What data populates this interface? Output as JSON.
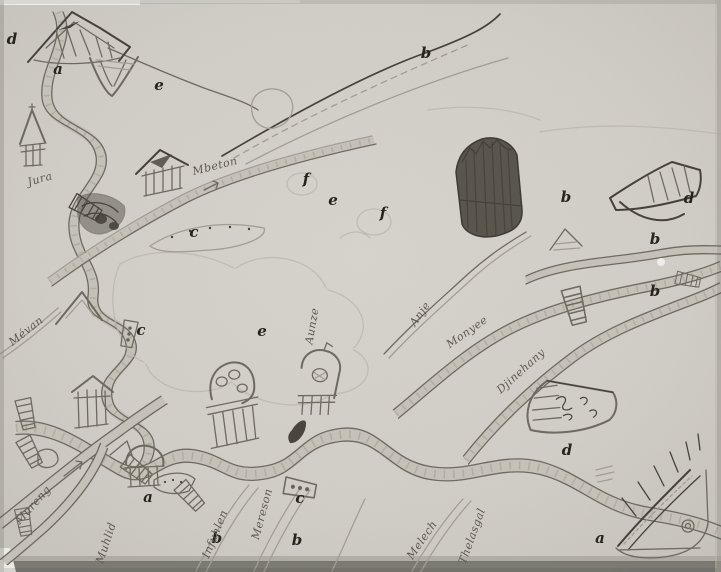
{
  "figure": {
    "type": "hand-drawn map",
    "description": "Halftone reproduction of a child's pencil-drawn sketch map showing winding rivers, roads, ladder bridges, churches with domes, houses and shaded hills, annotated with printed italic reference letters and handwritten place names."
  },
  "colors": {
    "paper": "#d2cfc8",
    "paper_light": "#d8d5cf",
    "paper_dark": "#c6c3bb",
    "pencil": "#6f6a60",
    "pencil_dark": "#46423b",
    "printed_ink": "#26241f",
    "bottom_shadow": "#6f6c66",
    "margin_white": "#eceae5"
  },
  "map": {
    "letter_annotations": [
      {
        "text": "d",
        "x": 12,
        "y": 39
      },
      {
        "text": "a",
        "x": 58,
        "y": 69
      },
      {
        "text": "e",
        "x": 159,
        "y": 85
      },
      {
        "text": "b",
        "x": 426,
        "y": 53
      },
      {
        "text": "f",
        "x": 306,
        "y": 179
      },
      {
        "text": "e",
        "x": 333,
        "y": 200
      },
      {
        "text": "f",
        "x": 383,
        "y": 213
      },
      {
        "text": "b",
        "x": 566,
        "y": 197
      },
      {
        "text": "d",
        "x": 689,
        "y": 198
      },
      {
        "text": "b",
        "x": 655,
        "y": 239
      },
      {
        "text": "c",
        "x": 194,
        "y": 232
      },
      {
        "text": "b",
        "x": 655,
        "y": 291
      },
      {
        "text": "c",
        "x": 141,
        "y": 330
      },
      {
        "text": "e",
        "x": 262,
        "y": 331
      },
      {
        "text": "a",
        "x": 148,
        "y": 497
      },
      {
        "text": "c",
        "x": 300,
        "y": 498
      },
      {
        "text": "b",
        "x": 217,
        "y": 538
      },
      {
        "text": "b",
        "x": 297,
        "y": 540
      },
      {
        "text": "d",
        "x": 567,
        "y": 450
      },
      {
        "text": "a",
        "x": 600,
        "y": 538
      }
    ],
    "place_names": [
      {
        "text": "Jura",
        "x": 40,
        "y": 179,
        "angle": -16
      },
      {
        "text": "Mbeton",
        "x": 215,
        "y": 166,
        "angle": -14
      },
      {
        "text": "Mévan",
        "x": 26,
        "y": 331,
        "angle": -38
      },
      {
        "text": "Anje",
        "x": 420,
        "y": 314,
        "angle": -55
      },
      {
        "text": "Monyee",
        "x": 467,
        "y": 332,
        "angle": -35
      },
      {
        "text": "Djinehany",
        "x": 521,
        "y": 371,
        "angle": -42
      },
      {
        "text": "Mureng",
        "x": 33,
        "y": 505,
        "angle": -48
      },
      {
        "text": "Muhlid",
        "x": 106,
        "y": 543,
        "angle": -72
      },
      {
        "text": "Infuhlen",
        "x": 215,
        "y": 534,
        "angle": -68
      },
      {
        "text": "Mereson",
        "x": 262,
        "y": 514,
        "angle": -75
      },
      {
        "text": "Melech",
        "x": 422,
        "y": 540,
        "angle": -55
      },
      {
        "text": "Thelasgal",
        "x": 472,
        "y": 536,
        "angle": -70
      },
      {
        "text": "Aunze",
        "x": 312,
        "y": 326,
        "angle": -80
      }
    ]
  }
}
